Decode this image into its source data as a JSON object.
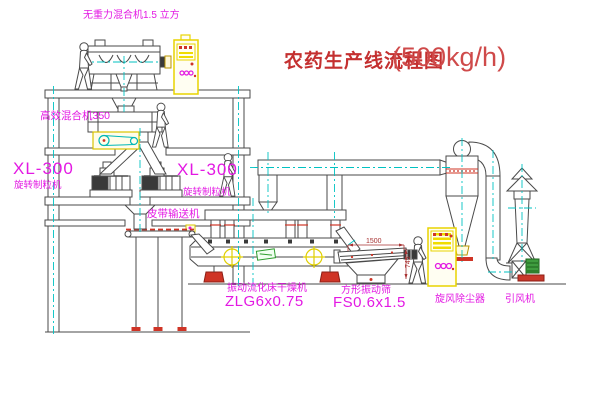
{
  "title": {
    "text": "农药生产线流程图",
    "capacity": "(500kg/h)"
  },
  "labels": {
    "top_mixer": "无重力混合机1.5 立方",
    "high_mixer": "高效混合机350",
    "granulator_left_model": "XL-300",
    "granulator_left_name": "旋转制粒机",
    "granulator_right_model": "XL-300",
    "granulator_right_name": "旋转制粒机",
    "belt_conveyor": "皮带输送机",
    "dryer_name": "振动流化床干燥机",
    "dryer_model": "ZLG6x0.75",
    "sieve_name": "方形振动筛",
    "sieve_model": "FS0.6x1.5",
    "cyclone": "旋风除尘器",
    "fan": "引风机"
  },
  "dimensions": {
    "sieve_length": "1500",
    "sieve_height": "745"
  },
  "colors": {
    "line": "#4a4a4a",
    "label_magenta": "#e319e3",
    "title_red": "#c43030",
    "capacity_red": "#cf4a4a",
    "centerline_cyan": "#00c2c2",
    "cabinet_yellow": "#e8d400",
    "accent_red": "#cf3426",
    "fan_green": "#3f9d3f",
    "dimension_red": "#a83232"
  }
}
